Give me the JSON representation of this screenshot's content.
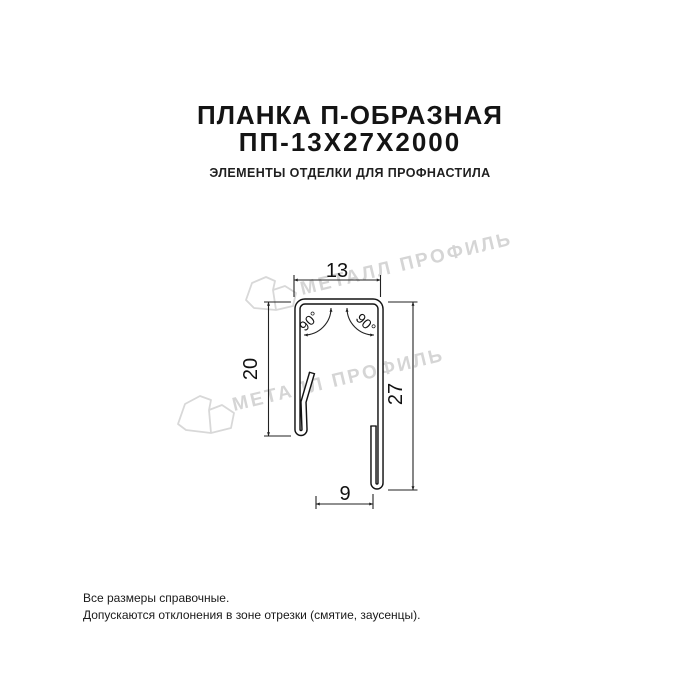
{
  "header": {
    "title_line1": "ПЛАНКА П-ОБРАЗНАЯ",
    "title_line2": "ПП-13Х27Х2000",
    "subtitle": "ЭЛЕМЕНТЫ ОТДЕЛКИ ДЛЯ ПРОФНАСТИЛА",
    "title_color": "#141414"
  },
  "drawing": {
    "dimensions": {
      "top_width": "13",
      "left_height": "20",
      "right_height": "27",
      "bottom_width": "9",
      "angle_left": "90°",
      "angle_right": "90°"
    },
    "profile_line_color": "#131313",
    "dim_line_color": "#222222"
  },
  "watermark": {
    "text": "МЕТАЛЛ ПРОФИЛЬ",
    "color": "#d5d5d5"
  },
  "footer": {
    "line1": "Все размеры справочные.",
    "line2": "Допускаются отклонения в зоне отрезки (смятие, заусенцы)."
  }
}
